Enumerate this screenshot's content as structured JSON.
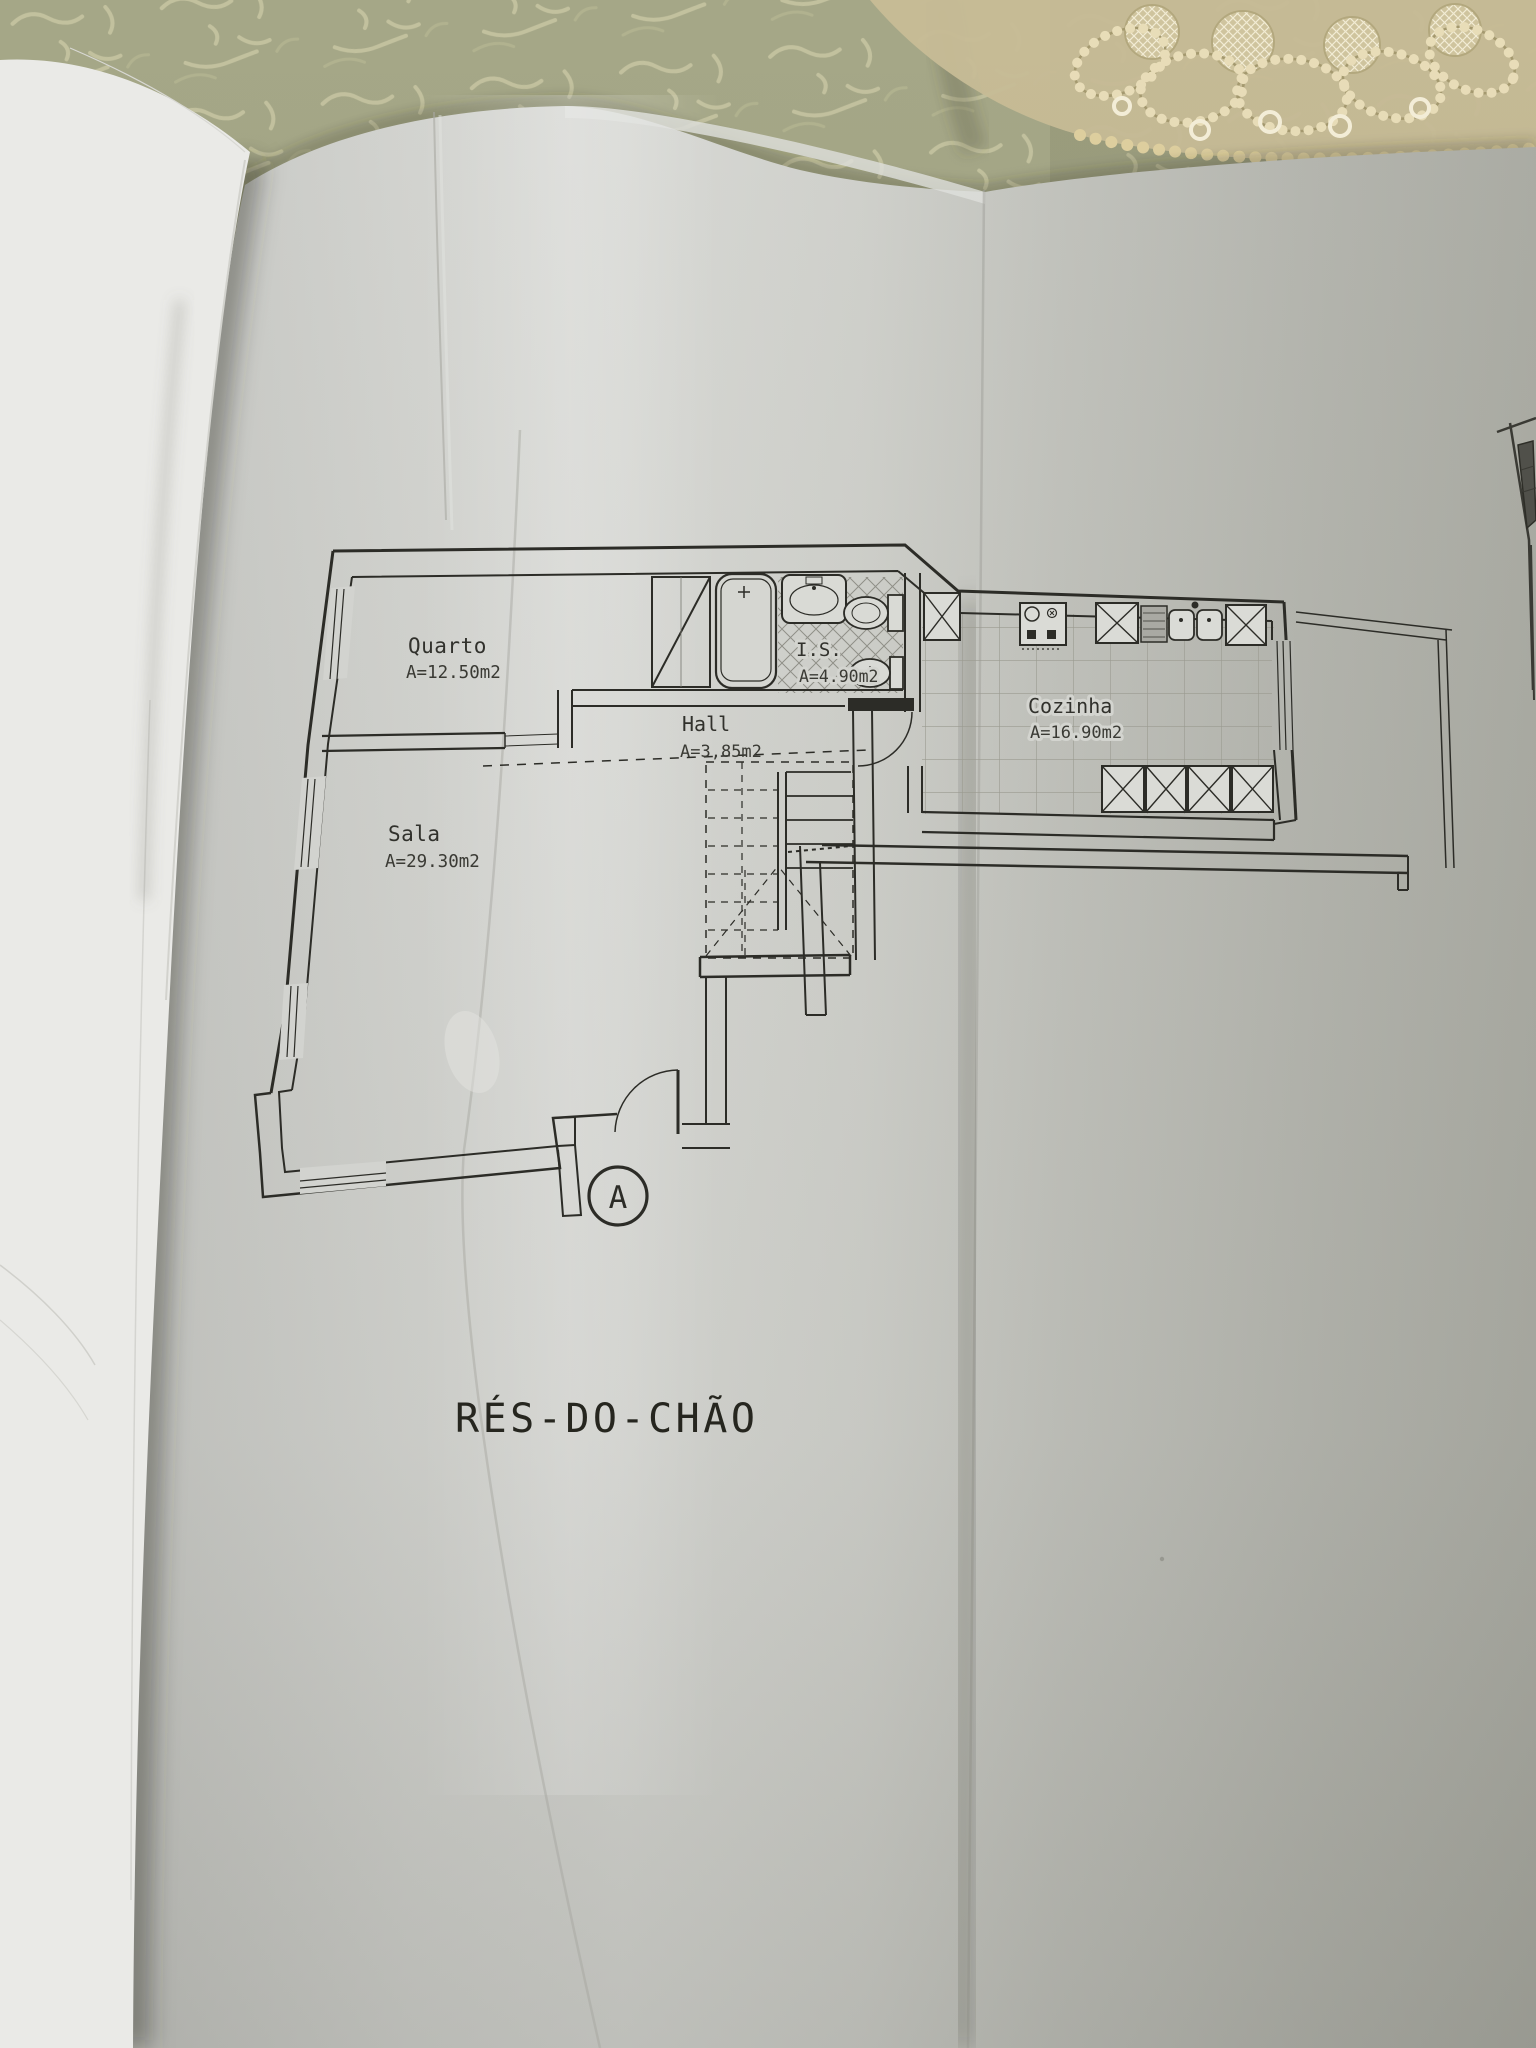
{
  "document": {
    "title": "RÉS-DO-CHÃO",
    "section_marker": "A"
  },
  "rooms": [
    {
      "name": "Quarto",
      "area": "A=12.50m2"
    },
    {
      "name": "Sala",
      "area": "A=29.30m2"
    },
    {
      "name": "Hall",
      "area": "A=3,85m2"
    },
    {
      "name": "I.S.",
      "area": "A=4.90m2"
    },
    {
      "name": "Cozinha",
      "area": "A=16.90m2"
    }
  ],
  "colors": {
    "ink": "#2c2c27",
    "paper": "#d2d3cf",
    "tablecloth": "#a5a787",
    "lace": "#c7bb96"
  }
}
